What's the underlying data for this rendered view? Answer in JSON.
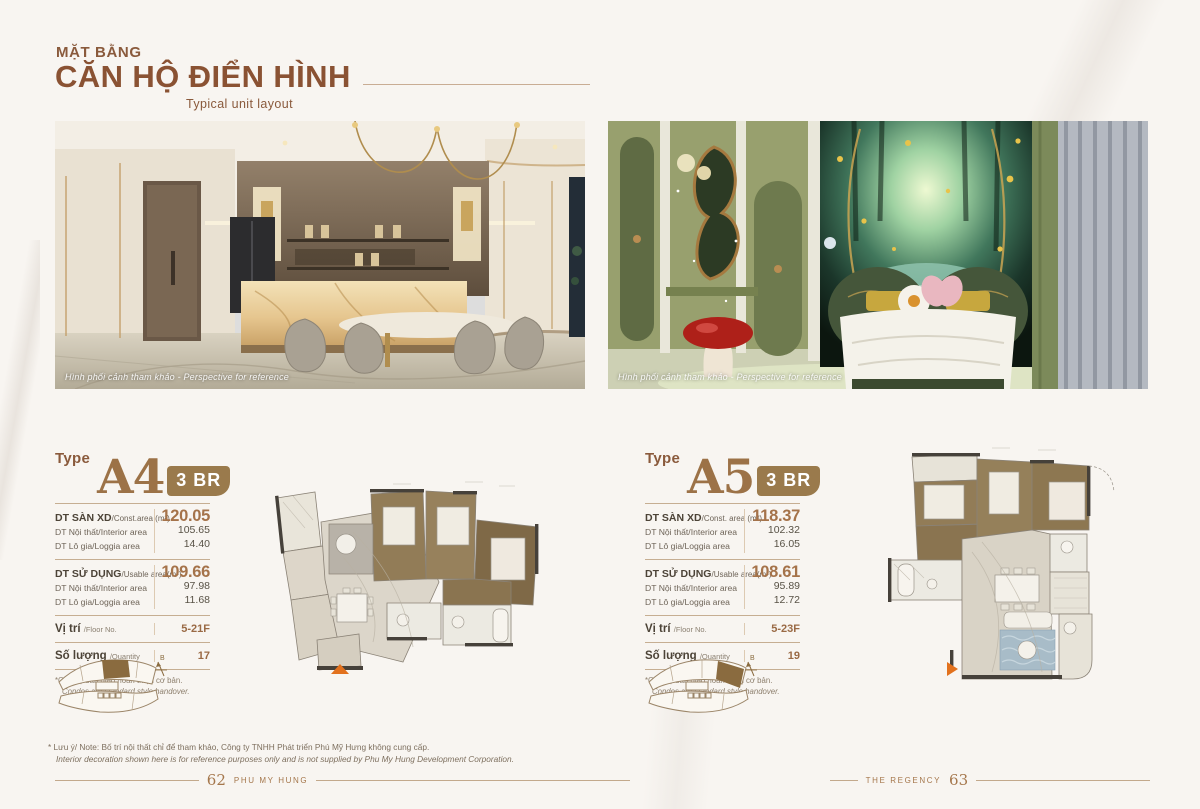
{
  "header": {
    "kicker": "MẶT BẰNG",
    "title": "CĂN HỘ ĐIỂN HÌNH",
    "subtitle": "Typical unit layout"
  },
  "photos": {
    "left_caption": "Hình phối cảnh tham khảo - Perspective for reference",
    "right_caption": "Hình phối cảnh tham khảo - Perspective for reference"
  },
  "units": [
    {
      "type_label": "Type",
      "code": "A4",
      "bedrooms": "3 BR",
      "groups": [
        {
          "label_vi": "DT SÀN XD",
          "label_en": "/Const.area (m²)",
          "value": "120.05",
          "subs": [
            {
              "label": "DT Nội thất/Interior area",
              "value": "105.65"
            },
            {
              "label": "DT Lô gia/Loggia area",
              "value": "14.40"
            }
          ]
        },
        {
          "label_vi": "DT SỬ DỤNG",
          "label_en": "/Usable area(m²)",
          "value": "109.66",
          "subs": [
            {
              "label": "DT Nội thất/Interior area",
              "value": "97.98"
            },
            {
              "label": "DT Lô gia/Loggia area",
              "value": "11.68"
            }
          ]
        }
      ],
      "floor_label": "Vị trí",
      "floor_label_en": "/Floor No.",
      "floor_value": "5-21F",
      "qty_label": "Số lượng",
      "qty_label_en": "/Quantity",
      "qty_value": "17",
      "footnote_vi": "*Căn hộ bàn giao hoàn thiện cơ bản.",
      "footnote_en": "Condos are standard style handover.",
      "compass": "B"
    },
    {
      "type_label": "Type",
      "code": "A5",
      "bedrooms": "3 BR",
      "groups": [
        {
          "label_vi": "DT SÀN XD",
          "label_en": "/Const. area (m²)",
          "value": "118.37",
          "subs": [
            {
              "label": "DT Nội thất/Interior area",
              "value": "102.32"
            },
            {
              "label": "DT Lô gia/Loggia area",
              "value": "16.05"
            }
          ]
        },
        {
          "label_vi": "DT SỬ DỤNG",
          "label_en": "/Usable area(m²)",
          "value": "108.61",
          "subs": [
            {
              "label": "DT Nội thất/Interior area",
              "value": "95.89"
            },
            {
              "label": "DT Lô gia/Loggia area",
              "value": "12.72"
            }
          ]
        }
      ],
      "floor_label": "Vị trí",
      "floor_label_en": "/Floor No.",
      "floor_value": "5-23F",
      "qty_label": "Số lượng",
      "qty_label_en": "/Quantity",
      "qty_value": "19",
      "footnote_vi": "*Căn hộ bàn giao hoàn thiện cơ bản.",
      "footnote_en": "Condos are standard style handover.",
      "compass": "B"
    }
  ],
  "note": {
    "line1": "* Lưu ý/ Note: Bố trí nội thất chỉ để tham khảo, Công ty TNHH Phát triển Phú Mỹ Hưng không cung cấp.",
    "line2": "Interior decoration shown here is for reference purposes only and is not supplied by Phu My Hung Development Corporation."
  },
  "footer": {
    "left_page": "62",
    "left_brand": "PHU MY HUNG",
    "right_brand": "THE REGENCY",
    "right_page": "63"
  },
  "colors": {
    "accent_brown": "#8a5a3c",
    "value_brown": "#a5734a",
    "badge_brown": "#9a7a4c",
    "rule_tan": "#c9ad94",
    "plan_highlight": "#8a6b3f",
    "entrance_arrow": "#e2711d"
  }
}
